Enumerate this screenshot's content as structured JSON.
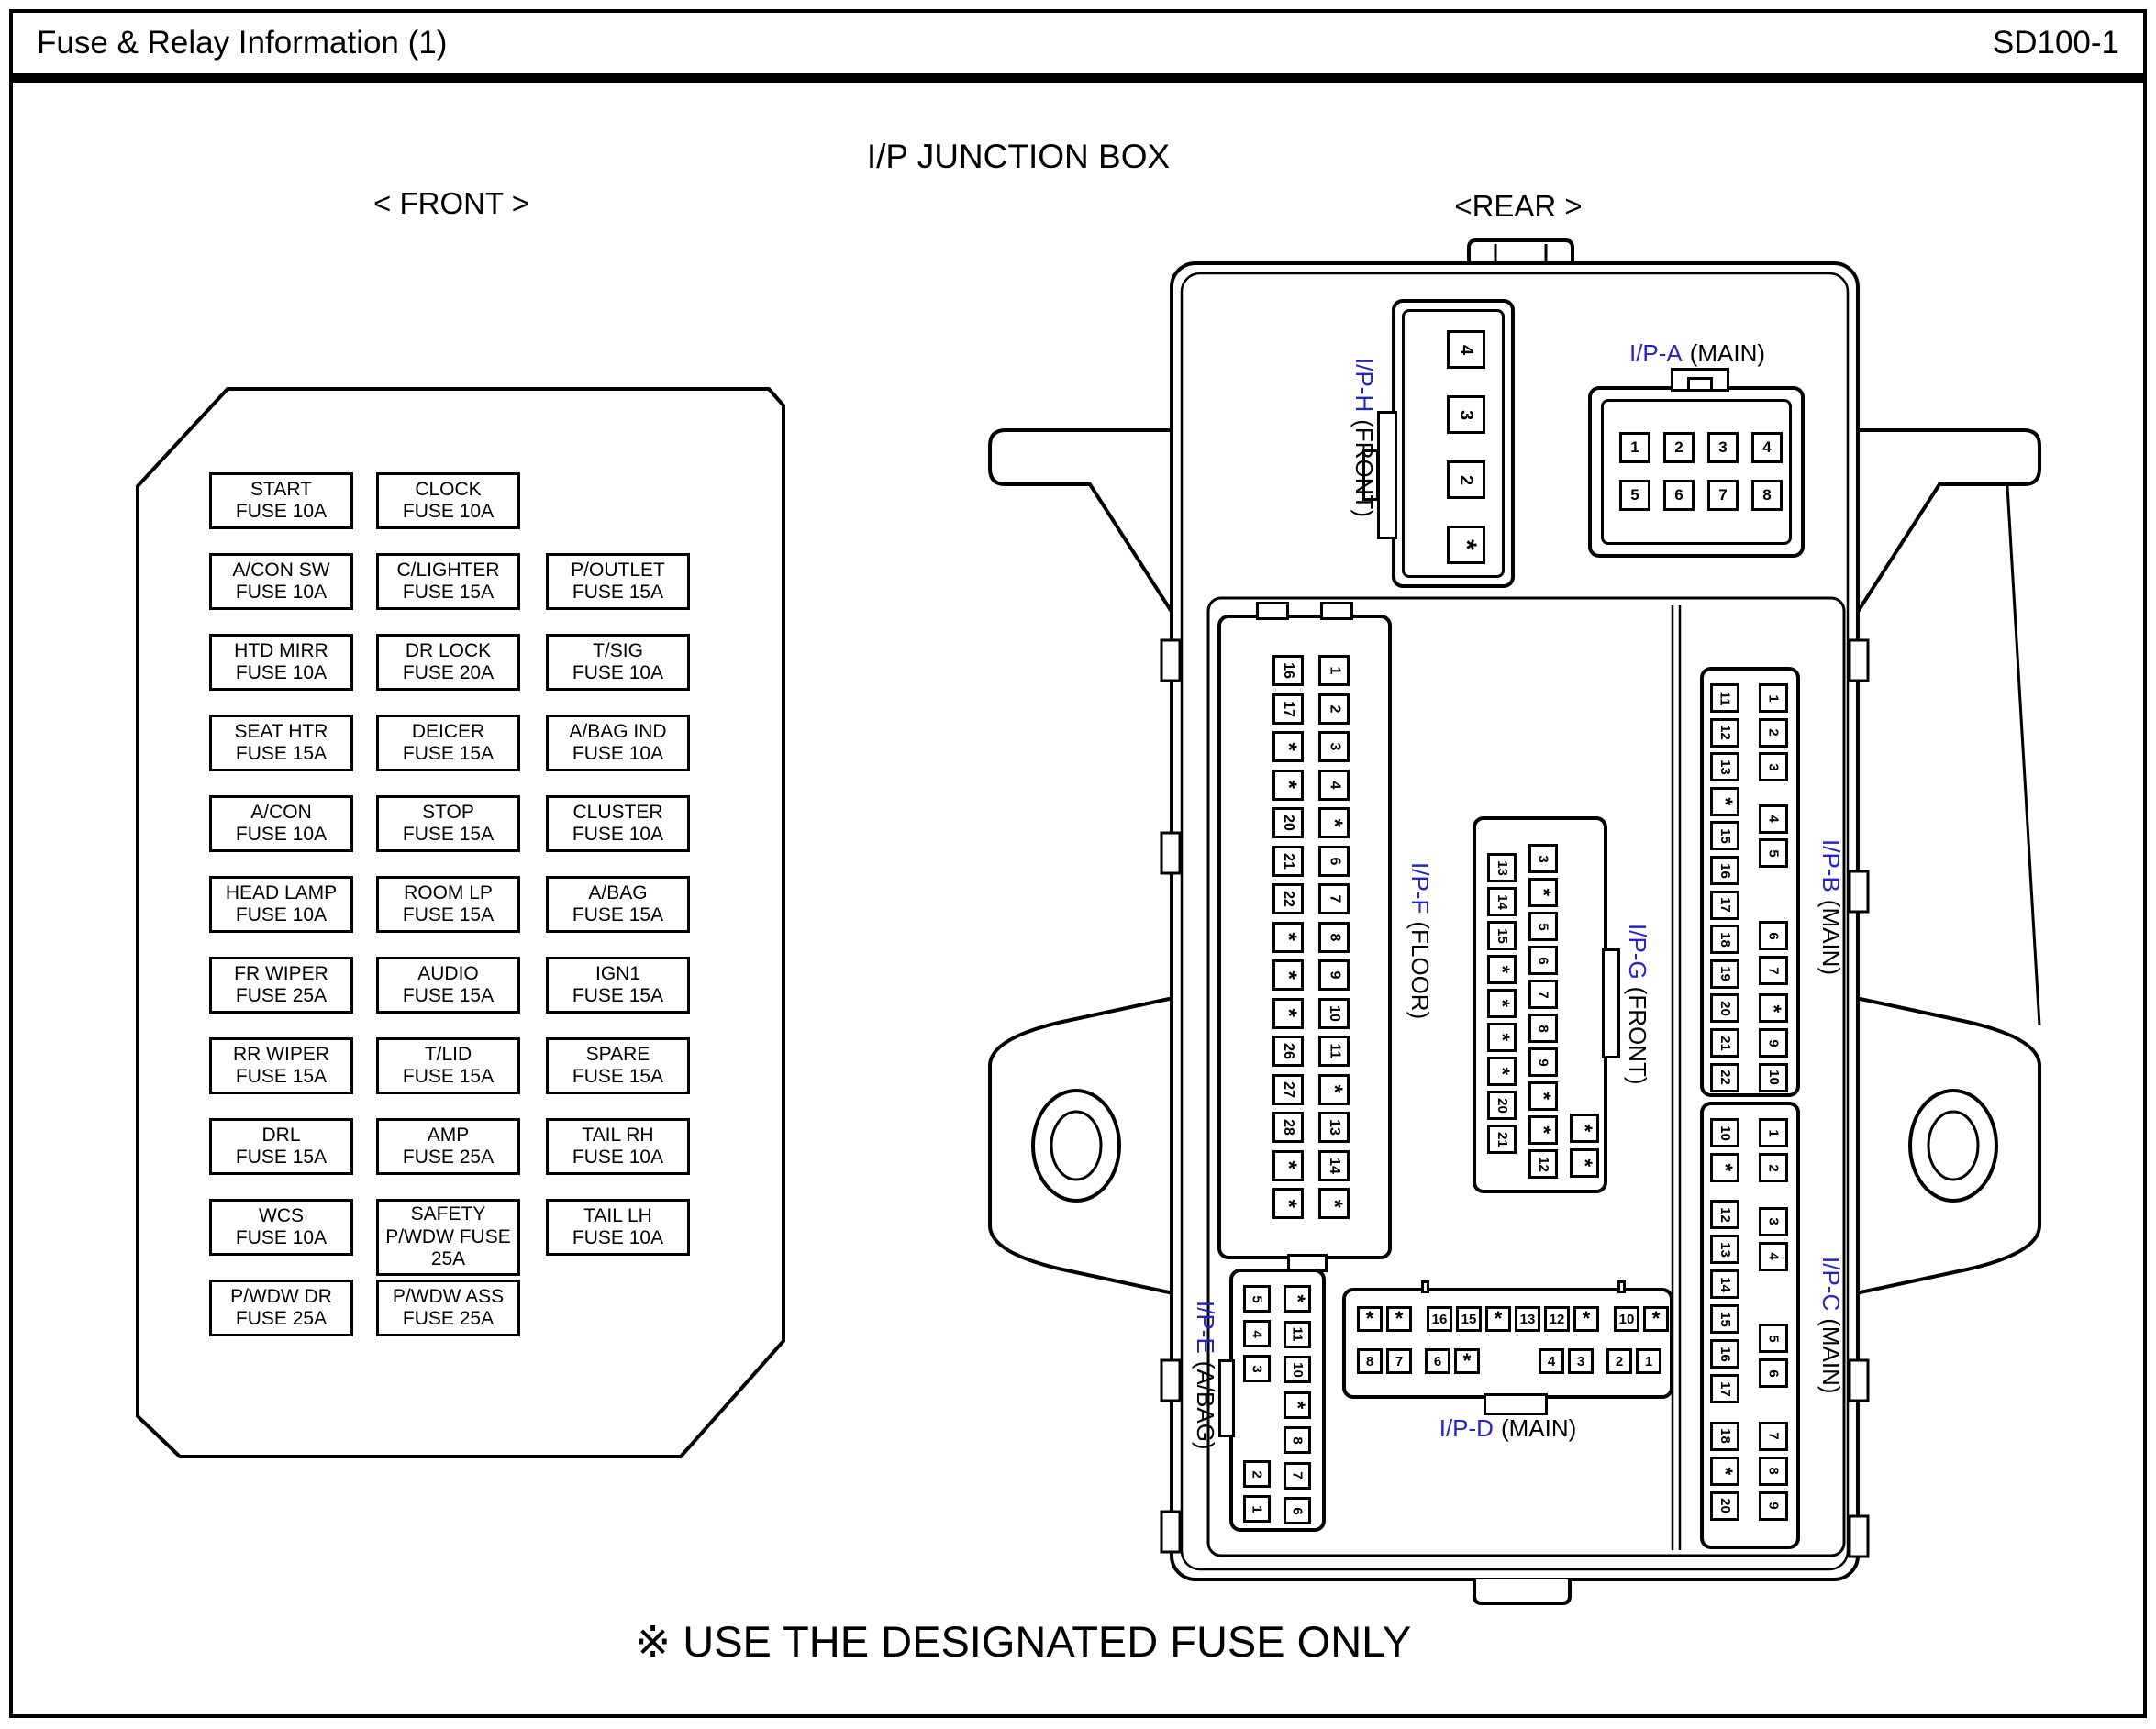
{
  "header": {
    "title": "Fuse & Relay Information (1)",
    "code": "SD100-1"
  },
  "diagram": {
    "title": "I/P JUNCTION BOX",
    "front_label": "< FRONT >",
    "rear_label": "<REAR >",
    "footer_note": "※ USE THE DESIGNATED FUSE ONLY"
  },
  "colors": {
    "label_blue": "#2323cd",
    "line": "#000000",
    "background": "#ffffff"
  },
  "front_panel": {
    "rows": [
      [
        [
          "START",
          "FUSE 10A"
        ],
        [
          "CLOCK",
          "FUSE 10A"
        ],
        null
      ],
      [
        [
          "A/CON SW",
          "FUSE 10A"
        ],
        [
          "C/LIGHTER",
          "FUSE 15A"
        ],
        [
          "P/OUTLET",
          "FUSE 15A"
        ]
      ],
      [
        [
          "HTD MIRR",
          "FUSE 10A"
        ],
        [
          "DR LOCK",
          "FUSE 20A"
        ],
        [
          "T/SIG",
          "FUSE 10A"
        ]
      ],
      [
        [
          "SEAT HTR",
          "FUSE 15A"
        ],
        [
          "DEICER",
          "FUSE 15A"
        ],
        [
          "A/BAG IND",
          "FUSE 10A"
        ]
      ],
      [
        [
          "A/CON",
          "FUSE 10A"
        ],
        [
          "STOP",
          "FUSE 15A"
        ],
        [
          "CLUSTER",
          "FUSE 10A"
        ]
      ],
      [
        [
          "HEAD LAMP",
          "FUSE 10A"
        ],
        [
          "ROOM LP",
          "FUSE 15A"
        ],
        [
          "A/BAG",
          "FUSE 15A"
        ]
      ],
      [
        [
          "FR WIPER",
          "FUSE 25A"
        ],
        [
          "AUDIO",
          "FUSE 15A"
        ],
        [
          "IGN1",
          "FUSE 15A"
        ]
      ],
      [
        [
          "RR WIPER",
          "FUSE 15A"
        ],
        [
          "T/LID",
          "FUSE 15A"
        ],
        [
          "SPARE",
          "FUSE 15A"
        ]
      ],
      [
        [
          "DRL",
          "FUSE 15A"
        ],
        [
          "AMP",
          "FUSE 25A"
        ],
        [
          "TAIL RH",
          "FUSE 10A"
        ]
      ],
      [
        [
          "WCS",
          "FUSE 10A"
        ],
        [
          "SAFETY",
          "P/WDW FUSE",
          "25A"
        ],
        [
          "TAIL LH",
          "FUSE 10A"
        ]
      ],
      [
        [
          "P/WDW DR",
          "FUSE 25A"
        ],
        [
          "P/WDW ASS",
          "FUSE 25A"
        ],
        null
      ]
    ]
  },
  "rear_connectors": {
    "ip_h": {
      "name": "I/P-H",
      "type": "(FRONT)",
      "pins": [
        "4",
        "3",
        "2",
        "*"
      ]
    },
    "ip_a": {
      "name": "I/P-A",
      "type": "(MAIN)",
      "row1": [
        "1",
        "2",
        "3",
        "4"
      ],
      "row2": [
        "5",
        "6",
        "7",
        "8"
      ]
    },
    "ip_f": {
      "name": "I/P-F",
      "type": "(FLOOR)",
      "left": [
        "16",
        "17",
        "*",
        "*",
        "20",
        "21",
        "22",
        "*",
        "*",
        "*",
        "26",
        "27",
        "28",
        "*",
        "*"
      ],
      "right": [
        "1",
        "2",
        "3",
        "4",
        "*",
        "6",
        "7",
        "8",
        "9",
        "10",
        "11",
        "*",
        "13",
        "14",
        "*"
      ]
    },
    "ip_g": {
      "name": "I/P-G",
      "type": "(FRONT)",
      "left": [
        "13",
        "14",
        "15",
        "*",
        "*",
        "*",
        "*",
        "20",
        "21"
      ],
      "mid": [
        "3",
        "*",
        "5",
        "6",
        "7",
        "8",
        "9",
        "*",
        "*",
        "12"
      ],
      "right": [
        "*",
        "*"
      ]
    },
    "ip_b": {
      "name": "I/P-B",
      "type": "(MAIN)",
      "left": [
        "11",
        "12",
        "13",
        "*",
        "15",
        "16",
        "17",
        "18",
        "19",
        "20",
        "21",
        "22"
      ],
      "right": [
        "1",
        "2",
        "3",
        "4",
        "5",
        "6",
        "7",
        "*",
        "9",
        "10"
      ]
    },
    "ip_c": {
      "name": "I/P-C",
      "type": "(MAIN)",
      "left": [
        "10",
        "*",
        "12",
        "13",
        "14",
        "15",
        "16",
        "17",
        "18",
        "*",
        "20"
      ],
      "right": [
        "1",
        "2",
        "3",
        "4",
        "5",
        "6",
        "7",
        "8",
        "9"
      ]
    },
    "ip_d": {
      "name": "I/P-D",
      "type": "(MAIN)",
      "top": [
        "*",
        "*",
        "16",
        "15",
        "*",
        "13",
        "12",
        "*",
        "10",
        "*"
      ],
      "bottom": [
        "8",
        "7",
        "6",
        "*",
        "4",
        "3",
        "2",
        "1"
      ]
    },
    "ip_e": {
      "name": "I/P-E",
      "type": "(A/BAG)",
      "left": [
        "5",
        "4",
        "3",
        "2",
        "1"
      ],
      "right": [
        "*",
        "11",
        "10",
        "*",
        "8",
        "7",
        "6"
      ]
    }
  }
}
